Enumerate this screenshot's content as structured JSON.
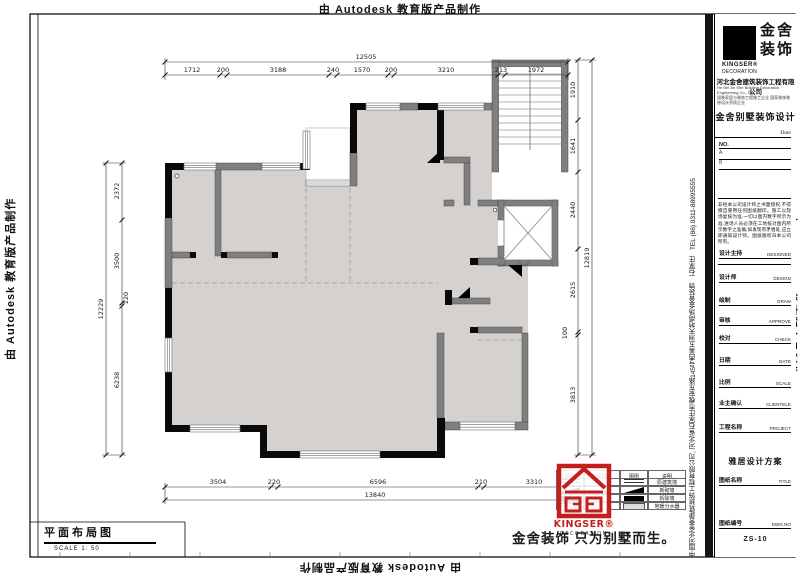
{
  "watermark": {
    "text": "由 Autodesk 教育版产品制作"
  },
  "plan_label": {
    "title": "平面布局图",
    "scale": "SCALE 1: 50"
  },
  "slogan": "金舍装饰 只为别墅而生。",
  "seal": {
    "brand": "KINGSER®",
    "sub": "DECORATION"
  },
  "legend": {
    "headers": [
      "图例",
      "说明",
      "图例",
      "说明"
    ],
    "rows": [
      "原建筑墙",
      "新砌墙",
      "拆除墙",
      "地暖分水器"
    ]
  },
  "dimensions": {
    "top": {
      "overall": "12505",
      "segments": [
        "1712",
        "200",
        "3188",
        "240",
        "1570",
        "200",
        "3210",
        "213",
        "1972"
      ]
    },
    "bottom": {
      "overall": "13840",
      "segments": [
        "3504",
        "220",
        "6596",
        "210",
        "3310"
      ]
    },
    "left": {
      "overall": "12229",
      "segments": [
        "2372",
        "3500",
        "120",
        "6238"
      ]
    },
    "right": {
      "overall": "12819",
      "segments": [
        "1910",
        "1641",
        "2440",
        "2615",
        "100",
        "3813"
      ]
    }
  },
  "titleblock": {
    "logo": {
      "cn1": "金舍",
      "cn2": "装饰",
      "brand": "KINGSER®",
      "brand_sub": "DECORATION"
    },
    "company": "河北金舍建筑装饰工程有限公司",
    "company_en": "He Bei Jin She Building Decoration Engineering Co., Ltd",
    "company_line2": "固装家居与装饰工程施工企业 国家装饰装修设计资质企业",
    "project_type": "金舍别墅装饰设计",
    "date_label": "Date",
    "no_label": "NO.",
    "no_rows": [
      "A",
      "B"
    ],
    "notes": "非经本公司设计师之书面授权,不得擅自重用任何图纸翻印。施工以现场复核为准,一切以图内数字所示为准,进场人员必须在工地核对图内所示数字之准确,如发现有矛盾处,应立即通知设计师。图纸版权归本公司所有。",
    "rows": [
      {
        "label": "设计主持",
        "en": "DESIGNED"
      },
      {
        "label": "设计师",
        "en": "DESIGN"
      },
      {
        "label": "绘制",
        "en": "DRAW"
      },
      {
        "label": "审核",
        "en": "APPROVE"
      },
      {
        "label": "校对",
        "en": "CHECK"
      },
      {
        "label": "日期",
        "en": "DATE"
      },
      {
        "label": "比例",
        "en": "SCALE"
      },
      {
        "label": "业主确认",
        "en": "CLIENTELE"
      }
    ],
    "project_label": "工程名称",
    "project_en": "PROJECT",
    "project_value": "雅居设计方案",
    "title_label": "图纸名称",
    "title_en": "TITLE",
    "dwg_label": "图纸编号",
    "dwg_en": "DWG.NO",
    "dwg_value": "ZS-10"
  },
  "side_text": "中国河北金舍建筑装饰工程有限公司, 河北省石家庄市槐安东路145号西美五洲天地商场金舍装饰　石家庄　TEL (86) 0311-88995555"
}
